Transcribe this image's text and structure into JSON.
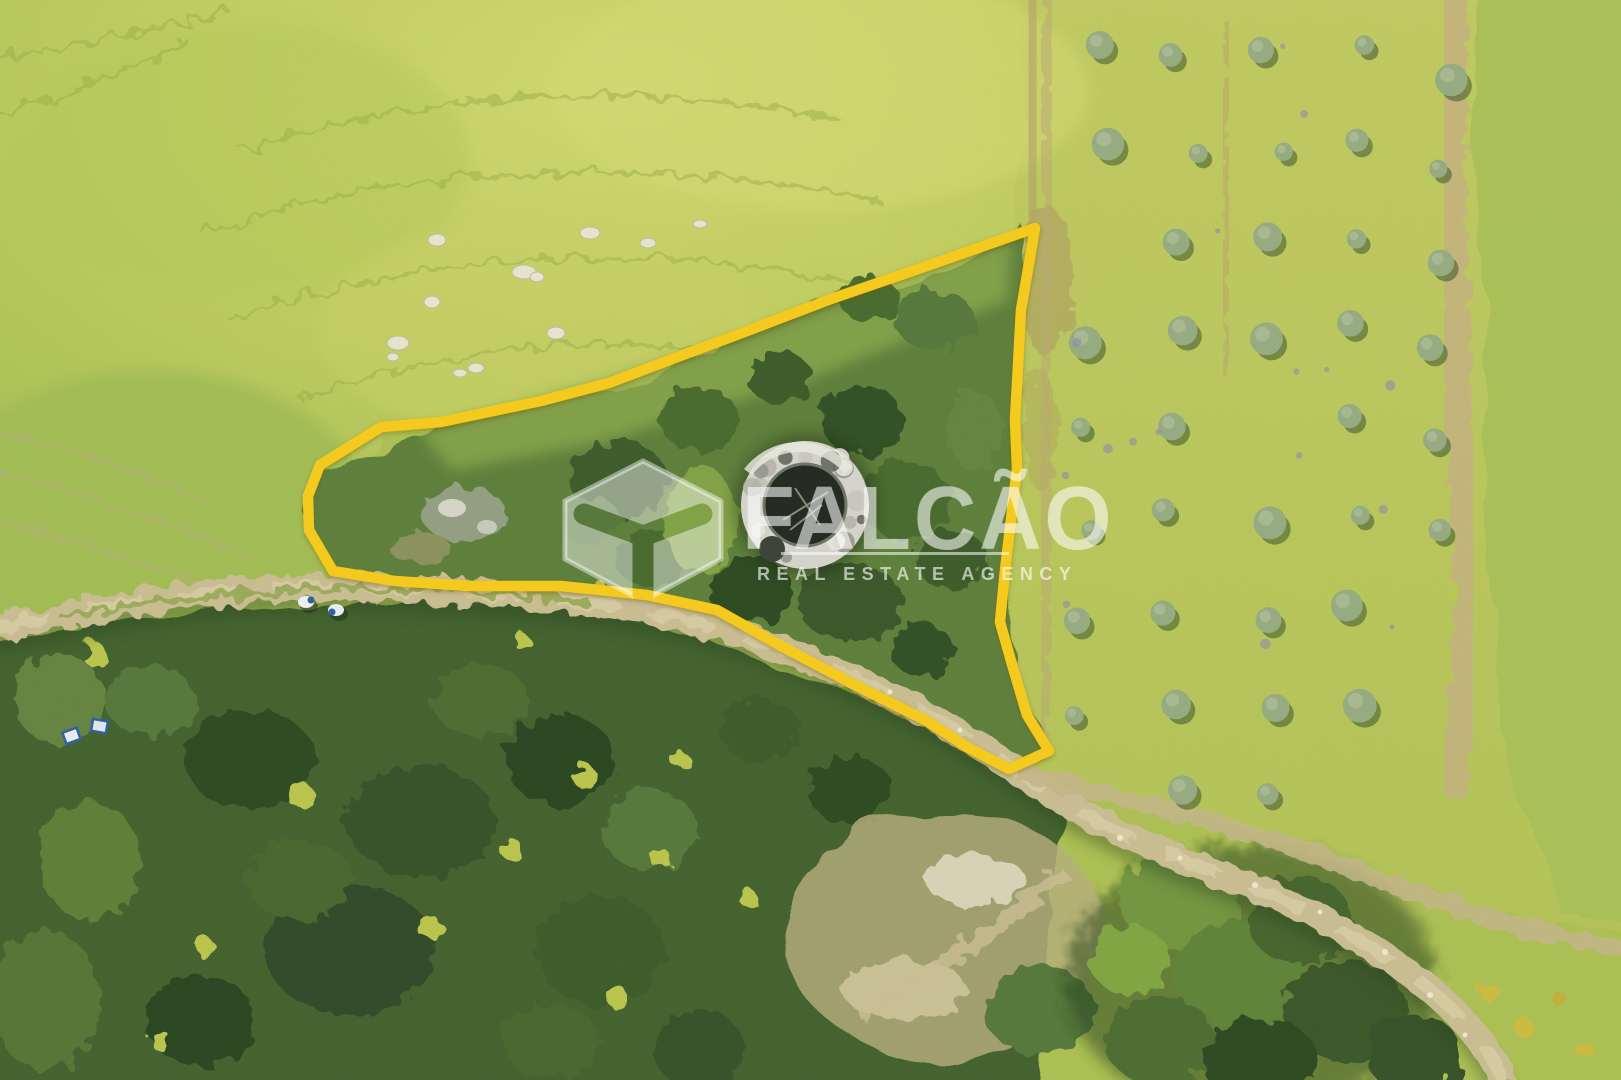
{
  "watermark": {
    "brand": "FALCÃO",
    "tagline": "REAL ESTATE AGENCY",
    "logo": "cube-isometric-logo"
  },
  "colors": {
    "parcel_outline": "#f3c81a",
    "watermark_white": "rgba(255,255,255,0.5)",
    "meadow": "#bfcc62",
    "grove_field": "#b9c65c",
    "forest": "#42612e",
    "dirt_road": "#c7ba8e",
    "stone_ruin": "#d3d2c9"
  }
}
